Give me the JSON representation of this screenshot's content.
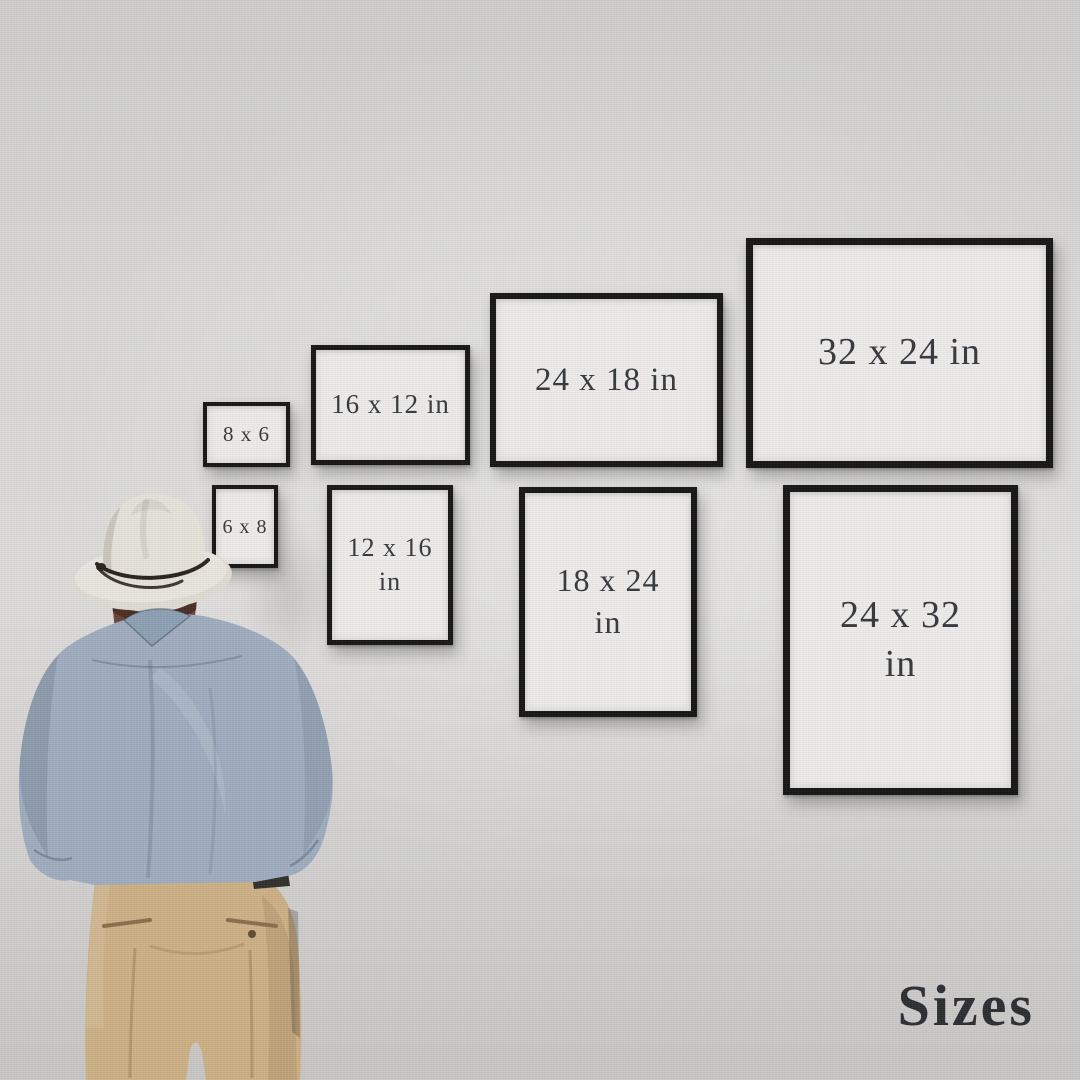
{
  "scene": {
    "description": "Man in a cream fedora, blue shirt and khaki trousers viewed from behind, looking at eight black-framed prints on a gray wall showing available print sizes",
    "colors": {
      "wall": "#d7d6d4",
      "frame": "#161616",
      "paper": "#edecea",
      "label_text": "#383b3f",
      "caption_text": "#2c2e32",
      "hat": "#e7e4dc",
      "hat_band": "#2a231c",
      "hair": "#6b4536",
      "shirt": "#9fadbf",
      "pants": "#cdb086"
    }
  },
  "frames": [
    {
      "name": "8x6",
      "orientation": "landscape",
      "lines": [
        "8 x 6"
      ]
    },
    {
      "name": "16x12",
      "orientation": "landscape",
      "lines": [
        "16 x 12 in"
      ]
    },
    {
      "name": "24x18",
      "orientation": "landscape",
      "lines": [
        "24 x 18 in"
      ]
    },
    {
      "name": "32x24",
      "orientation": "landscape",
      "lines": [
        "32 x 24 in"
      ]
    },
    {
      "name": "6x8",
      "orientation": "portrait",
      "lines": [
        "6 x 8"
      ]
    },
    {
      "name": "12x16",
      "orientation": "portrait",
      "lines": [
        "12 x 16",
        "in"
      ]
    },
    {
      "name": "18x24",
      "orientation": "portrait",
      "lines": [
        "18 x 24",
        "in"
      ]
    },
    {
      "name": "24x32",
      "orientation": "portrait",
      "lines": [
        "24 x 32",
        "in"
      ]
    }
  ],
  "caption": {
    "text": "Sizes"
  }
}
